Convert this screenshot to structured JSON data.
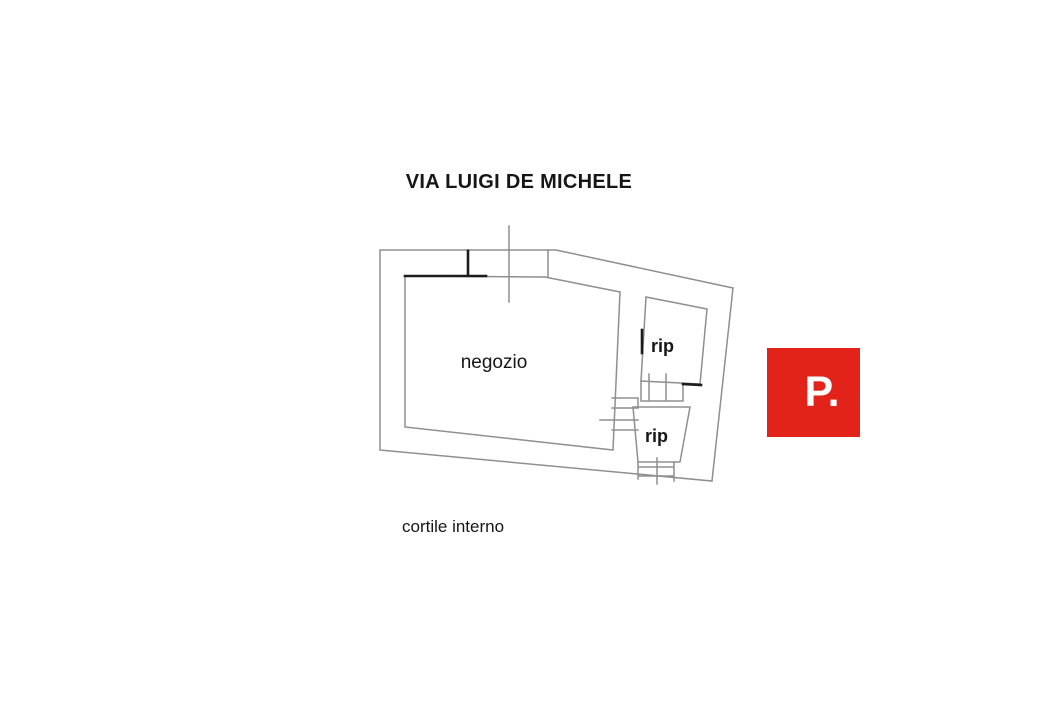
{
  "plan": {
    "street_label": "VIA LUIGI DE MICHELE",
    "rooms": {
      "negozio": "negozio",
      "rip_top": "rip",
      "rip_bottom": "rip"
    },
    "courtyard_label": "cortile interno",
    "line_color": "#8f8f8f",
    "accent_line_color": "#1c1c1c",
    "text_color": "#161616"
  },
  "watermark": {
    "label": "P.",
    "background": "#e2231a",
    "text_color": "#ffffff"
  }
}
